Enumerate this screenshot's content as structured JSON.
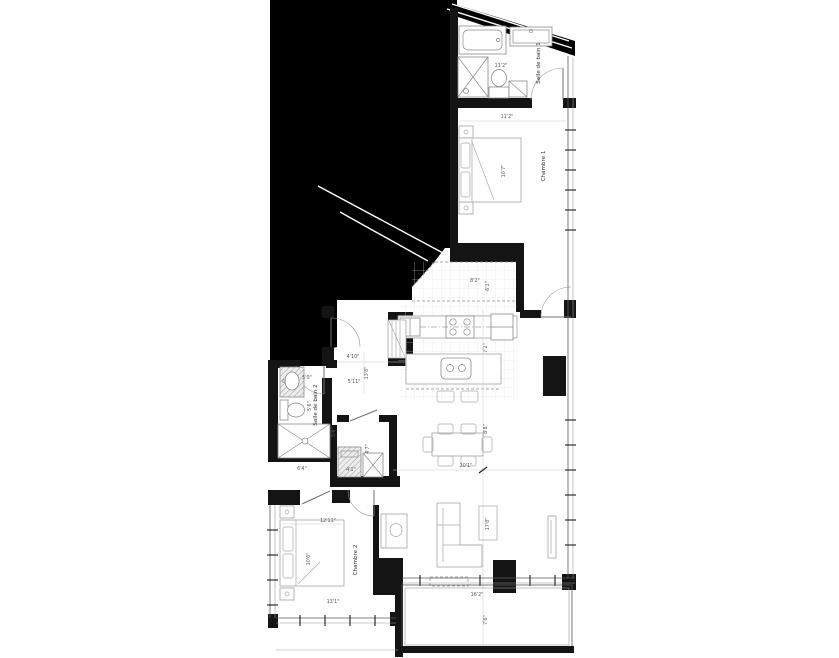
{
  "title": "Apartment floor plan",
  "colors": {
    "mask": "#000000",
    "wall": "#141414",
    "furniture_line": "#a3a3a3",
    "dimension_text": "#555555",
    "background": "#ffffff"
  },
  "rooms": {
    "bath1": "Salle de bain 1",
    "bedroom1": "Chambre 1",
    "bath2": "Salle de bain 2",
    "bedroom2": "Chambre 2"
  },
  "dimensions": {
    "bath1_width": "11'2\"",
    "bedroom1_width": "11'2\"",
    "bedroom1_depth": "10'7\"",
    "kitchen_nook_width": "8'2\"",
    "kitchen_nook_depth": "6'2\"",
    "kitchen_zone_depth": "7'2\"",
    "dining_zone_depth": "8'8\"",
    "great_room_length": "20'1\"",
    "living_width": "17'8\"",
    "balcony_width": "16'2\"",
    "balcony_depth": "7'6\"",
    "entry_width": "4'10\"",
    "corridor_length": "13'8\"",
    "entry_depth": "5'11\"",
    "bath2_width": "5'0\"",
    "bath2_depth": "5'6\"",
    "laundry_width": "4'1\"",
    "laundry_depth": "4'7\"",
    "closet_depth": "5'6\"",
    "hall_width": "6'4\"",
    "bedroom2_width": "12'11\"",
    "bedroom2_depth": "10'6\"",
    "bedroom2_length": "13'1\""
  }
}
